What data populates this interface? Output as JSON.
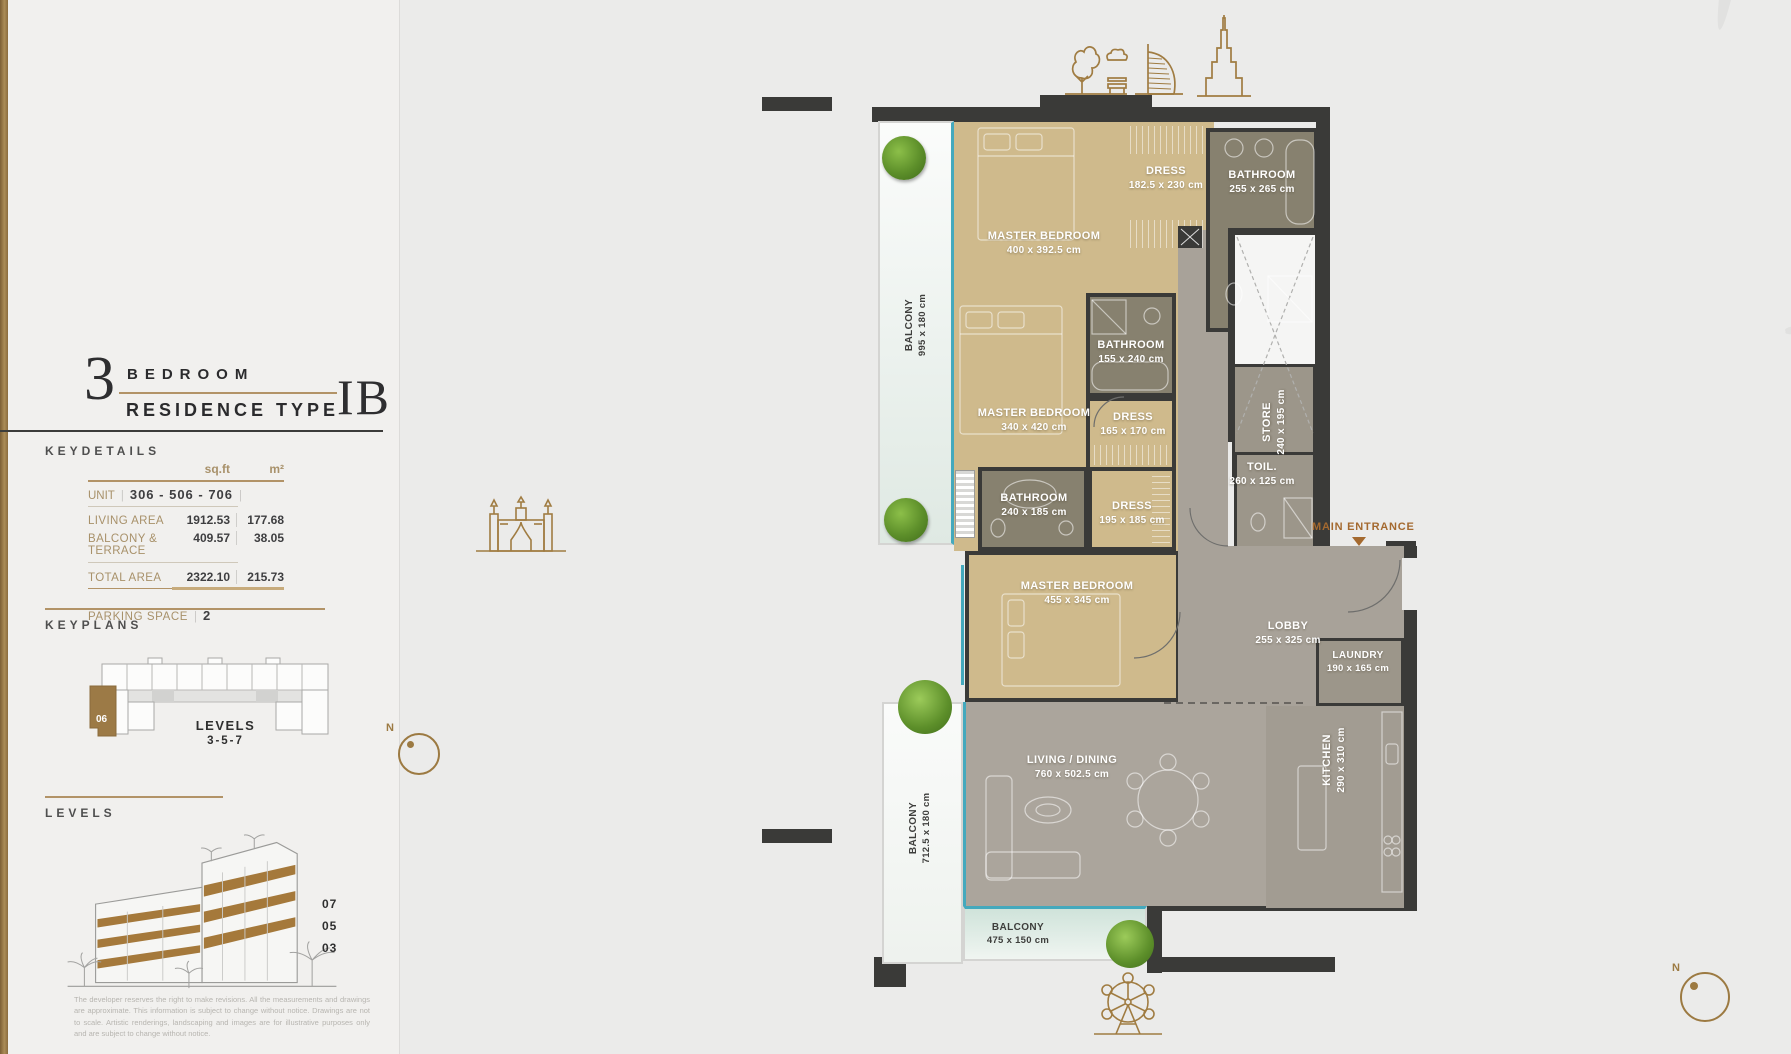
{
  "title": {
    "number": "3",
    "word1": "BEDROOM",
    "word2": "RESIDENCE TYPE",
    "type_code": "IB"
  },
  "keydetails": {
    "heading": "KEYDETAILS",
    "col_sqft": "sq.ft",
    "col_m2": "m²",
    "unit_label": "UNIT",
    "unit_value": "306 - 506 - 706",
    "rows": [
      {
        "label": "LIVING AREA",
        "sqft": "1912.53",
        "m2": "177.68"
      },
      {
        "label": "BALCONY & TERRACE",
        "sqft": "409.57",
        "m2": "38.05"
      },
      {
        "label": "TOTAL AREA",
        "sqft": "2322.10",
        "m2": "215.73"
      }
    ],
    "parking_label": "PARKING SPACE",
    "parking_value": "2"
  },
  "keyplans": {
    "heading": "KEYPLANS",
    "unit_number": "06",
    "levels_caption_line1": "LEVELS",
    "levels_caption_line2": "3-5-7",
    "compass_n": "N"
  },
  "levels": {
    "heading": "LEVELS",
    "floors": [
      "07",
      "05",
      "03"
    ],
    "disclaimer": "The developer reserves the right to make revisions. All the measurements and drawings are approximate. This information is subject to change without notice. Drawings are not to scale. Artistic renderings, landscaping and images are for illustrative purposes only and are subject to change without notice."
  },
  "plan": {
    "compass_n": "N",
    "main_entrance": "MAIN ENTRANCE",
    "rooms": [
      {
        "label": "MASTER BEDROOM",
        "dims": "400 x 392.5 cm"
      },
      {
        "label": "DRESS",
        "dims": "182.5 x 230 cm"
      },
      {
        "label": "BATHROOM",
        "dims": "255 x 265 cm"
      },
      {
        "label": "MASTER BEDROOM",
        "dims": "340 x 420 cm"
      },
      {
        "label": "BATHROOM",
        "dims": "155 x 240 cm"
      },
      {
        "label": "DRESS",
        "dims": "165 x 170 cm"
      },
      {
        "label": "STORE",
        "dims": "240 x 195 cm"
      },
      {
        "label": "TOIL.",
        "dims": "260 x 125 cm"
      },
      {
        "label": "BATHROOM",
        "dims": "240 x 185 cm"
      },
      {
        "label": "DRESS",
        "dims": "195 x 185 cm"
      },
      {
        "label": "MASTER BEDROOM",
        "dims": "455 x 345 cm"
      },
      {
        "label": "LOBBY",
        "dims": "255 x 325 cm"
      },
      {
        "label": "LAUNDRY",
        "dims": "190 x 165 cm"
      },
      {
        "label": "KITCHEN",
        "dims": "290 x 310 cm"
      },
      {
        "label": "LIVING / DINING",
        "dims": "760 x 502.5 cm"
      },
      {
        "label": "BALCONY",
        "dims": "995 x 180 cm"
      },
      {
        "label": "BALCONY",
        "dims": "712.5 x 180 cm"
      },
      {
        "label": "BALCONY",
        "dims": "475 x 150 cm"
      }
    ]
  },
  "colors": {
    "accent_gold": "#a07c42",
    "wall": "#3a3a38",
    "bedroom_floor": "#cfba8c",
    "bath_floor": "#87816f",
    "gray_floor": "#a8a299",
    "balcony_line": "#44a9bd",
    "entrance_text": "#a4692f"
  }
}
